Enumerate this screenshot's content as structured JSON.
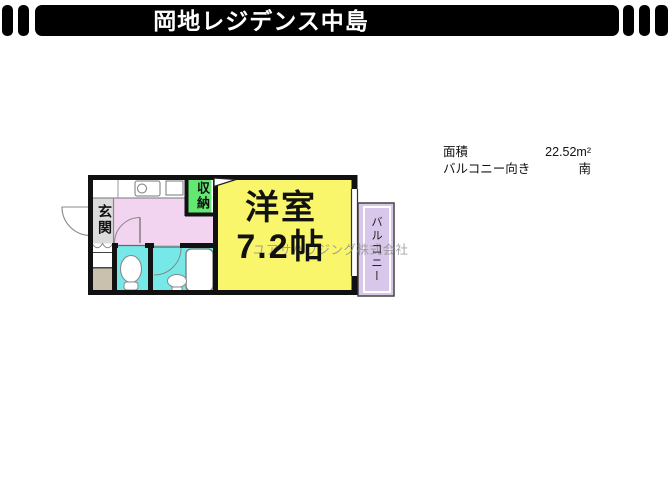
{
  "header": {
    "title": "岡地レジデンス中島"
  },
  "info": {
    "rows": [
      {
        "label": "面積",
        "value": "22.52m²"
      },
      {
        "label": "バルコニー向き",
        "value": "南"
      }
    ]
  },
  "floorplan": {
    "living_room_name": "洋室",
    "living_room_size": "7.2帖",
    "entrance_label": "玄関",
    "storage_label": "収納",
    "balcony_label": "バルコニー",
    "colors": {
      "living_room": "#f9f66b",
      "kitchen_hall": "#f2d4f1",
      "wet_rooms": "#76e8e8",
      "storage": "#63e872",
      "balcony": "#d9c7eb",
      "entrance": "#dbdbdb",
      "shoe_box": "#c9c0ad",
      "walls": "#111111"
    }
  },
  "watermark": "ユアサハウジング株式会社"
}
